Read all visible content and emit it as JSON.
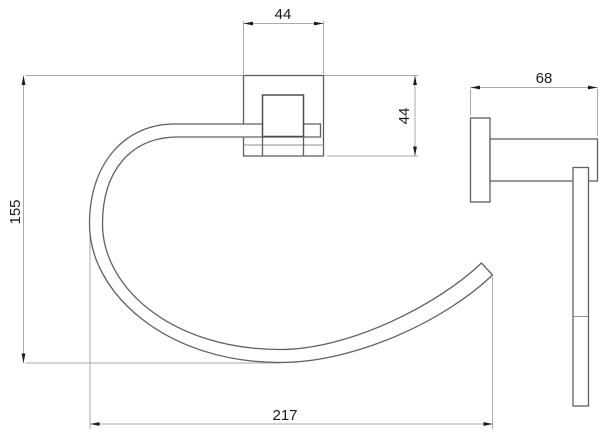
{
  "drawing": {
    "kind": "towel-ring-technical-dimension-drawing",
    "units_note": "",
    "colors": {
      "background": "#ffffff",
      "object_line": "#606060",
      "bracket_line": "#4d4d4d",
      "detail_line": "#8f8f8f",
      "dimension_line": "#a9a9a9",
      "arrow_and_text": "#1b1b1b"
    },
    "front_view": {
      "dims": {
        "plate_width": "44",
        "plate_height": "44",
        "overall_height": "155",
        "overall_width": "217"
      }
    },
    "side_view": {
      "dims": {
        "depth": "68"
      }
    }
  }
}
